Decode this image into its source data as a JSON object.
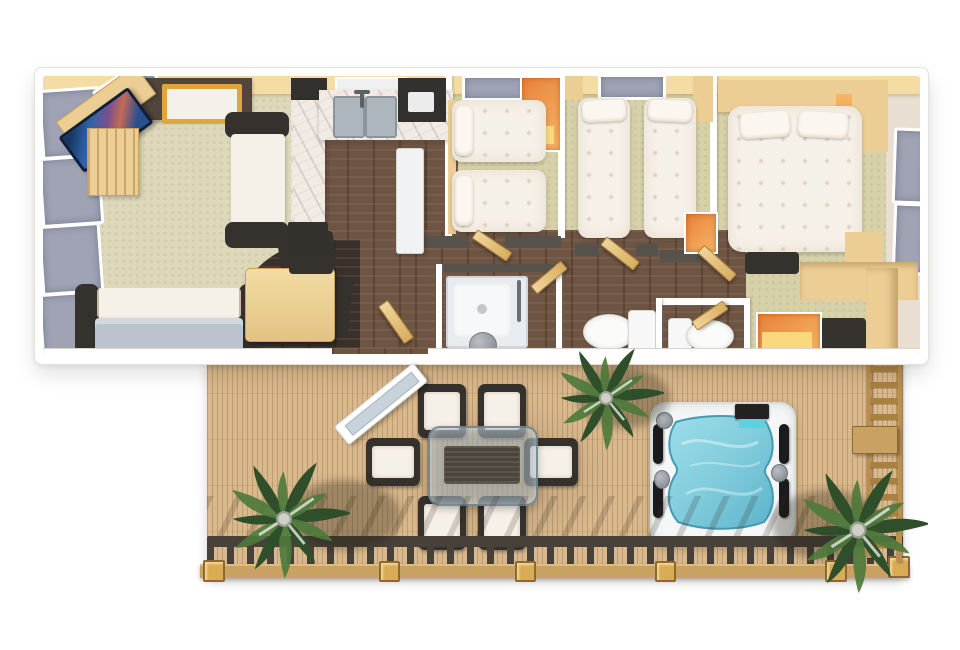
{
  "scene": {
    "type": "3d-floorplan-render",
    "description": "Top-down 3D architectural rendering of a holiday lodge / static caravan floor plan with an attached timber sun deck, outdoor dining set, hot tub, potted palms, railing and access ladder. No text labels are rendered in the image.",
    "canvas": {
      "width": 960,
      "height": 650
    },
    "background": "#ffffff"
  },
  "colors": {
    "page_bg": "#ffffff",
    "wall_white": "#ffffff",
    "wall_charcoal": "#57524b",
    "interior_beige": "#efe8db",
    "top_wall_wood": "#f4dca4",
    "living_carpet": "#ded8ba",
    "bedroom_carpet": "#d7d1a9",
    "dark_wood": "#6e5443",
    "nook_dark": "#3a312a",
    "marble": "#f2ebe3",
    "counter_dark": "#33312d",
    "furniture_wood": "#ecce94",
    "wood_deep": "#caa06a",
    "accent_orange": "#e8823c",
    "orange_glow": "#f6b565",
    "glow_yellow": "#f9d97c",
    "sofa_dark": "#35322e",
    "cushion_white": "#f6f1e8",
    "seat_gray": "#bcc3cf",
    "window_gray": "#9fa3b4",
    "tv_navy": "#1c3a6e",
    "fireplace_brown": "#52463c",
    "gold_trim": "#dfa63e",
    "appliance_white": "#f1f2f3",
    "sink_gray": "#aeb6bd",
    "deck_wood": "#d9b88c",
    "deck_line": "#b5966a",
    "deck_beam": "#c9a263",
    "post_gold": "#d9ab55",
    "rail_dark": "#474139",
    "ladder_wood": "#b98f52",
    "palm_green": "#2f4f2b",
    "palm_green_light": "#4e7a3c",
    "palm_trunk": "#cfd1c9",
    "tub_shell": "#f4f6f7",
    "tub_water": "#7ecbdc",
    "tub_water_deep": "#57b2c8",
    "tub_black": "#1b1b1d",
    "jet_gray": "#8d9399",
    "glass_gray": "#9fb0ba",
    "shower_gray": "#e9ecee"
  },
  "rooms": [
    {
      "id": "living-room",
      "furniture": [
        "corner-tv",
        "tv-cabinet",
        "fireplace",
        "l-sofa",
        "sofa-bed",
        "dining-table",
        "two-chairs",
        "left-windows"
      ]
    },
    {
      "id": "kitchen",
      "furniture": [
        "double-sink",
        "marble-worktops",
        "breakfast-bar",
        "fridge",
        "dark-counter"
      ]
    },
    {
      "id": "twin-bedroom-1",
      "furniture": [
        "single-bed",
        "single-bed",
        "orange-wardrobe",
        "window"
      ]
    },
    {
      "id": "twin-bedroom-2",
      "furniture": [
        "single-bed",
        "single-bed",
        "orange-wardrobe",
        "window",
        "shelf"
      ]
    },
    {
      "id": "master-bedroom",
      "furniture": [
        "double-bed",
        "two-pillows",
        "headboard-units",
        "wardrobes",
        "benches",
        "orange-wardrobe",
        "side-windows"
      ]
    },
    {
      "id": "shower-room",
      "furniture": [
        "shower-cubicle",
        "basin"
      ]
    },
    {
      "id": "wc-1",
      "furniture": [
        "toilet"
      ]
    },
    {
      "id": "wc-2",
      "furniture": [
        "toilet"
      ]
    },
    {
      "id": "hallway",
      "furniture": [
        "doors"
      ]
    }
  ],
  "deck": {
    "items": [
      "open-patio-door",
      "dining-table-glass",
      "six-deck-chairs",
      "hot-tub",
      "palm-plant-top",
      "palm-plant-bottom-left",
      "palm-plant-bottom-right",
      "bottom-railing",
      "access-ladder",
      "post-caps"
    ]
  }
}
